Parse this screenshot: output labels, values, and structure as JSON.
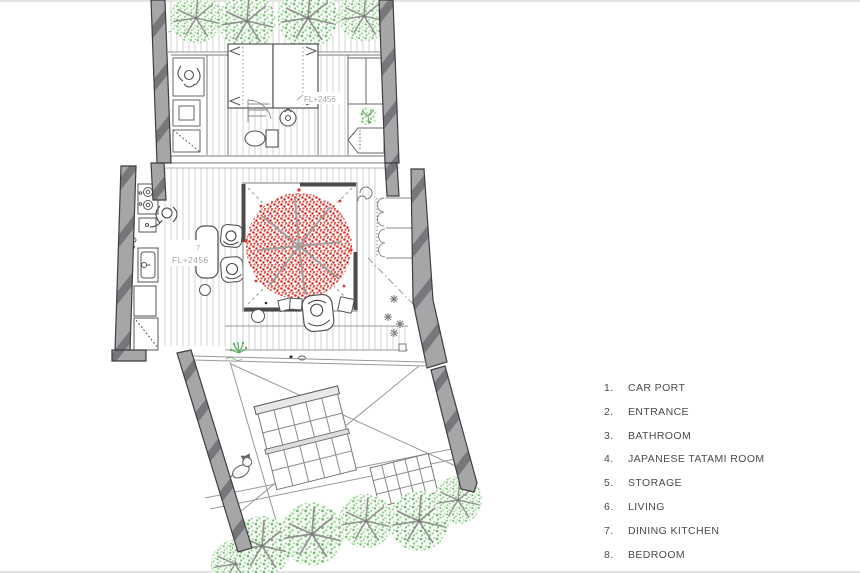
{
  "plan": {
    "labels": {
      "upper_floor_level": "FL+2456",
      "main_room_number": "7",
      "main_floor_level": "FL+2456"
    },
    "colors": {
      "wall_fill": "#a6a6a9",
      "wall_hatch": "#77777b",
      "wall_outline": "#3e3e40",
      "floor_hatch": "#cfcfcf",
      "line_gray": "#8c8c8c",
      "courtyard_border_dark": "#4b4b4d",
      "foliage_green": "#7dc47d",
      "blossom_red": "#e23025",
      "branch_gray": "#9f9f9f",
      "plan_label_text": "#a5a5a5",
      "legend_text": "#4a4a4a"
    }
  },
  "legend": {
    "items": [
      {
        "number": "1.",
        "label": "CAR PORT"
      },
      {
        "number": "2.",
        "label": "ENTRANCE"
      },
      {
        "number": "3.",
        "label": "BATHROOM"
      },
      {
        "number": "4.",
        "label": "JAPANESE TATAMI ROOM"
      },
      {
        "number": "5.",
        "label": "STORAGE"
      },
      {
        "number": "6.",
        "label": "LIVING"
      },
      {
        "number": "7.",
        "label": "DINING KITCHEN"
      },
      {
        "number": "8.",
        "label": "BEDROOM"
      }
    ]
  }
}
